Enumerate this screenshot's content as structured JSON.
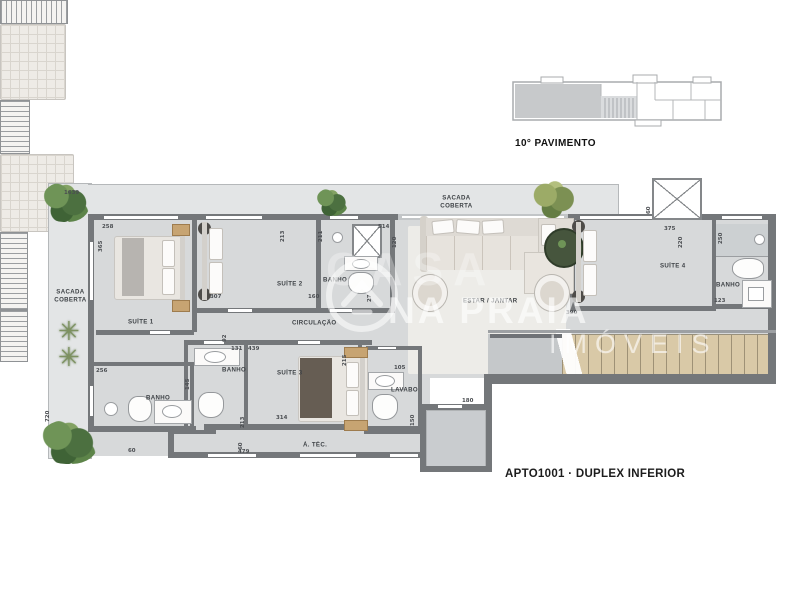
{
  "title": "APTO1001 · DUPLEX INFERIOR",
  "key_plan": {
    "label": "10° PAVIMENTO"
  },
  "watermark": {
    "casa": "CASA",
    "brand": "NA PRAIA",
    "sub": "IMÓVEIS"
  },
  "icons": {
    "palm_glyph": "✳"
  },
  "rooms": {
    "sacada_left": "SACADA COBERTA",
    "sacada_top": "SACADA COBERTA",
    "suite1": "SUÍTE 1",
    "suite2": "SUÍTE 2",
    "suite3": "SUÍTE 3",
    "suite4": "SUÍTE 4",
    "banho1": "BANHO",
    "banho2": "BANHO",
    "banho3": "BANHO",
    "banho4": "BANHO",
    "lavabo": "LAVABO",
    "circulacao": "CIRCULAÇÃO",
    "estar": "ESTAR / JANTAR",
    "atec": "Á. TÉC."
  },
  "dims": {
    "total_top": "1639",
    "suite1_w": "258",
    "suite1_h": "365",
    "suite2_w": "307",
    "suite2_r": "213",
    "banho2_l": "211",
    "banho2_top": "514",
    "banho2_t2": "120",
    "banho2_b": "160",
    "banho2_s": "27",
    "circ": "92",
    "banho3_t": "131",
    "banho3_l": "145",
    "suite3_t": "439",
    "suite3_r": "215",
    "suite3_l": "213",
    "suite3_b": "314",
    "banho1_t": "256",
    "sacada_h": "720",
    "sacada_b": "60",
    "lavabo_t": "105",
    "lavabo_r": "150",
    "atec_l": "60",
    "atec_b": "479",
    "hall_t": "180",
    "estar_r": "390",
    "suite4_t": "375",
    "suite4_t2": "220",
    "banho4_l": "250",
    "banho4_b": "123",
    "elev": "60"
  },
  "colors": {
    "wall": "#74777a",
    "floor": "#d7d9da",
    "balcony": "#e3e5e6",
    "stair": "#d9c9a7",
    "plant": "#4c7040"
  }
}
